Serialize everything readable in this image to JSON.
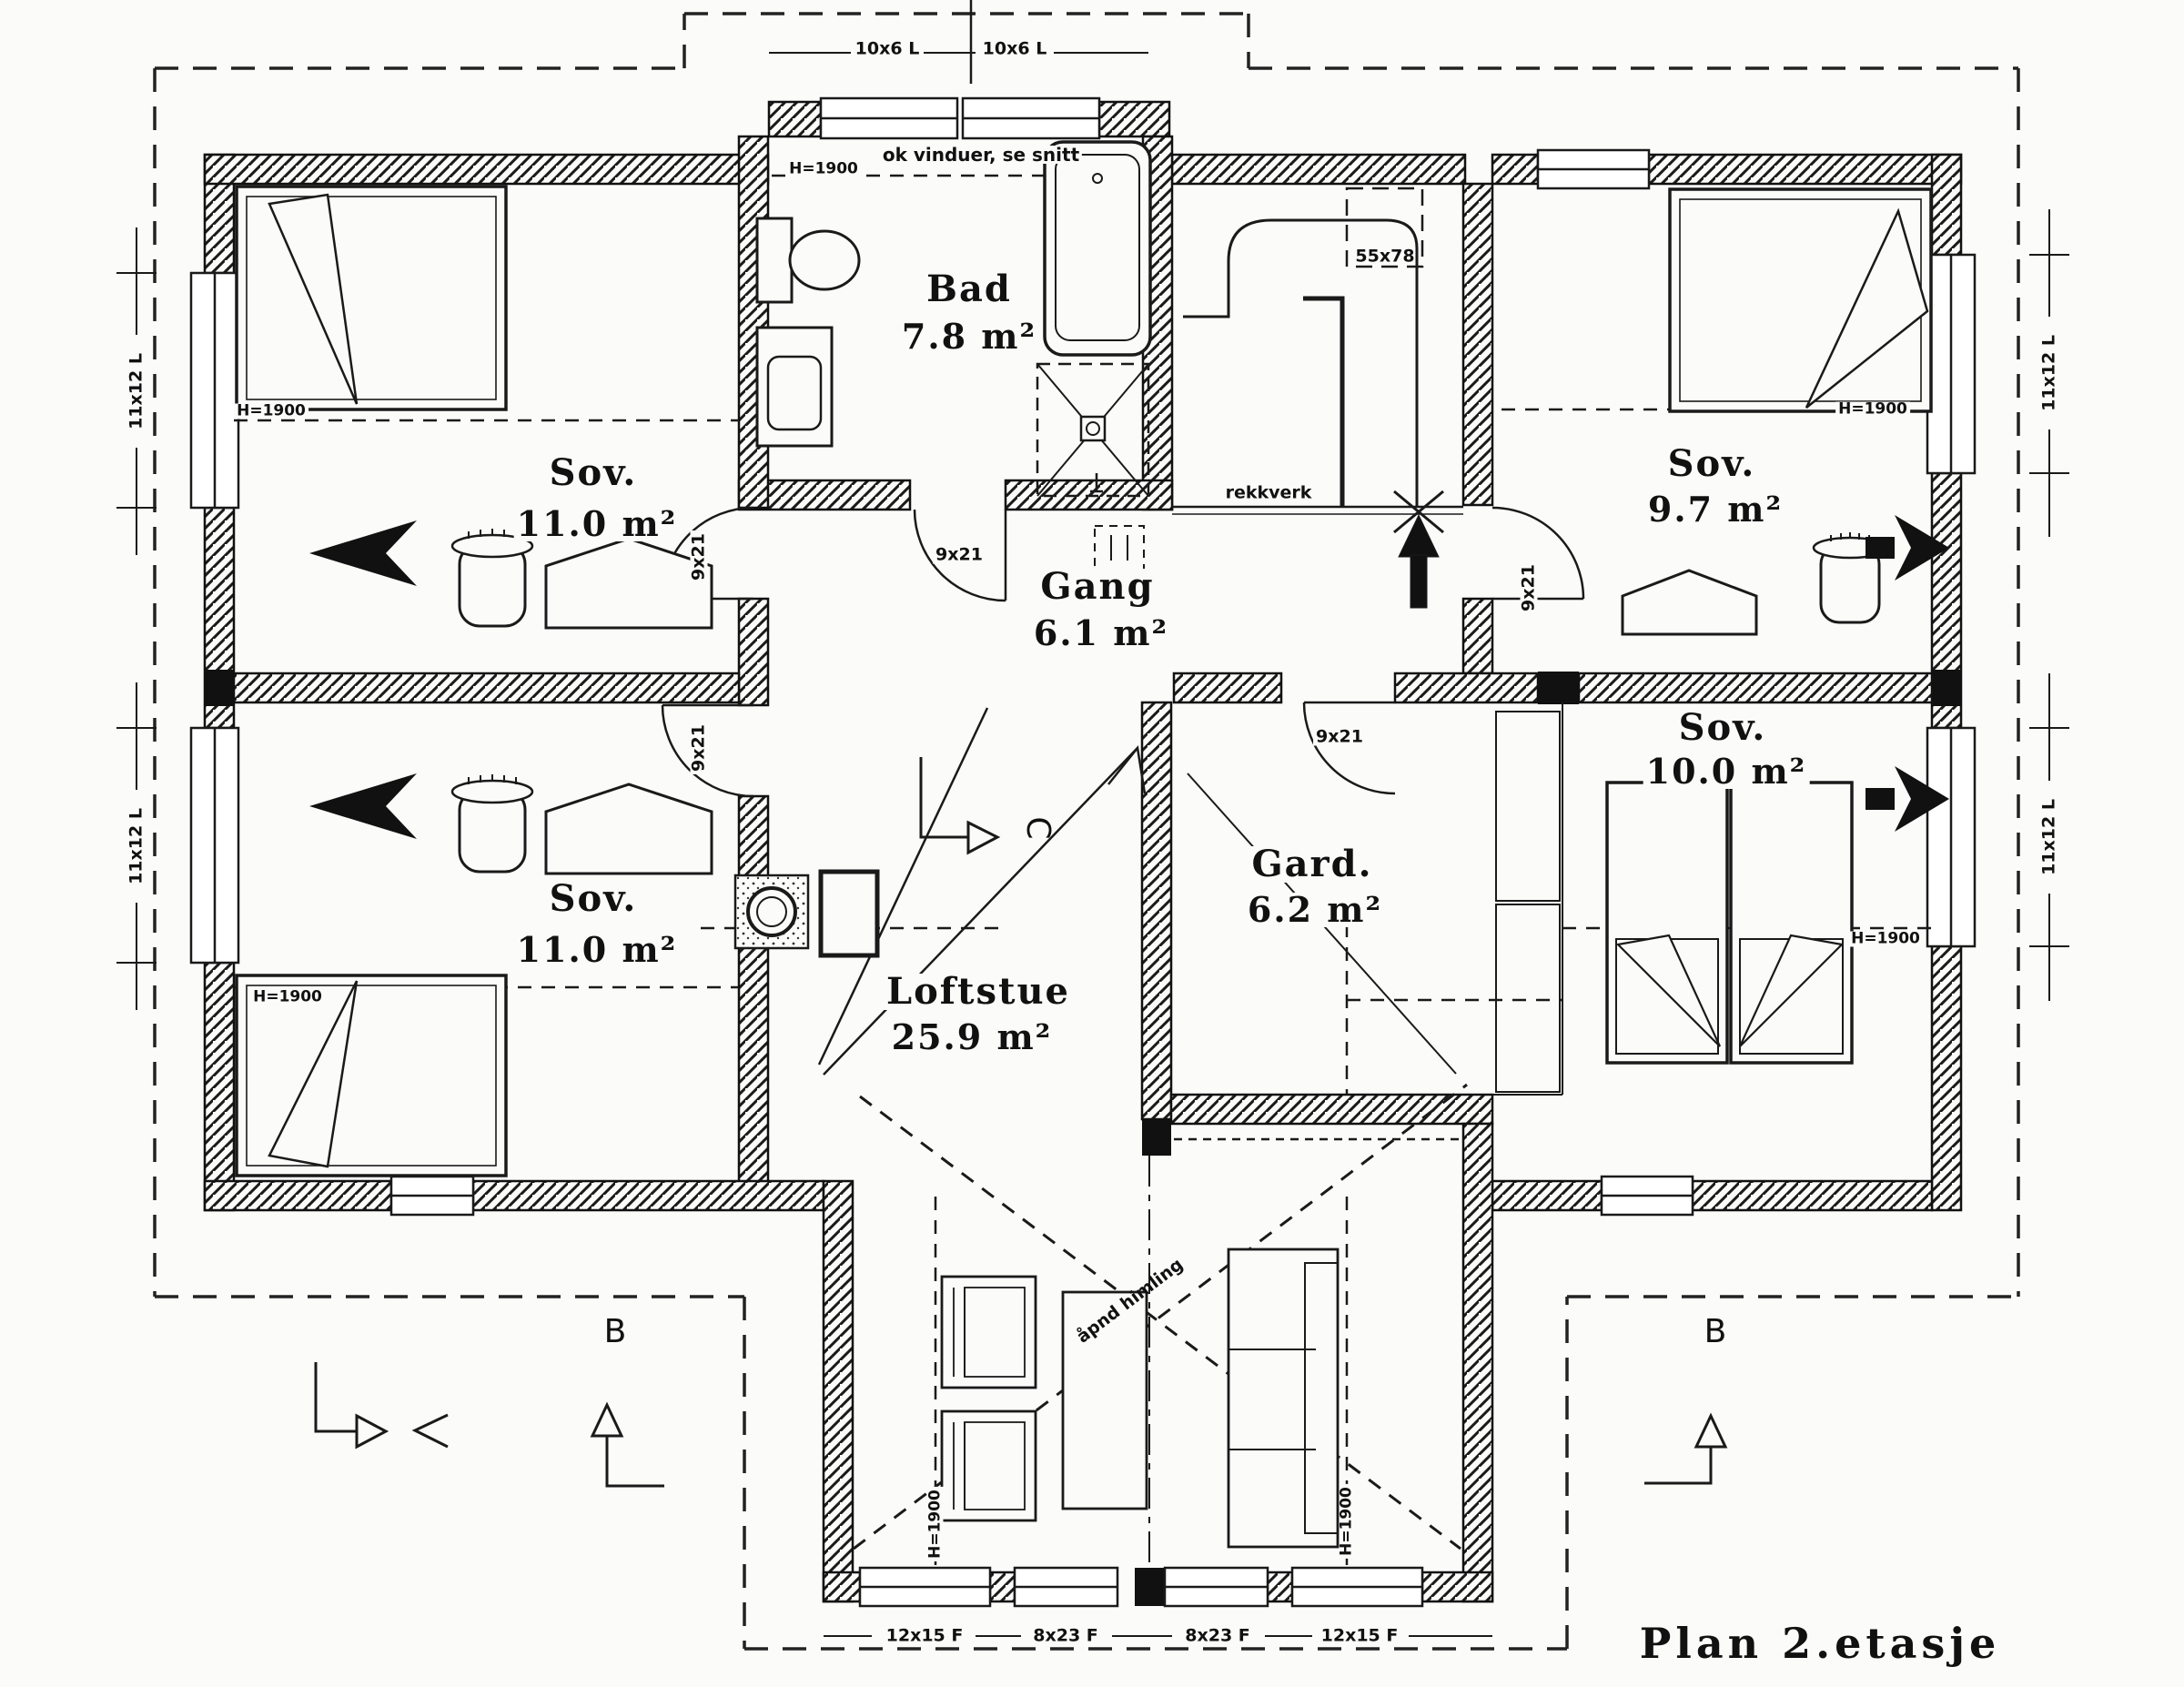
{
  "title": "Plan 2.etasje",
  "rooms": {
    "bad": {
      "name": "Bad",
      "area": "7.8 m²"
    },
    "sov_top_left": {
      "name": "Sov.",
      "area": "11.0 m²"
    },
    "sov_bottom_left": {
      "name": "Sov.",
      "area": "11.0 m²"
    },
    "sov_top_right": {
      "name": "Sov.",
      "area": "9.7 m²"
    },
    "sov_bottom_right": {
      "name": "Sov.",
      "area": "10.0 m²"
    },
    "gang": {
      "name": "Gang",
      "area": "6.1 m²"
    },
    "gard": {
      "name": "Gard.",
      "area": "6.2 m²"
    },
    "loftstue": {
      "name": "Loftstue",
      "area": "25.9 m²"
    }
  },
  "annotations": {
    "windows_note": "ok vinduer, se snitt",
    "railing": "rekkverk",
    "roof_window": "55x78",
    "open_ceiling": "åpnd himling",
    "ceiling_height": "H=1900",
    "door_size": "9x21",
    "dormer_window": "10x6 L",
    "side_window": "11x12 L",
    "bottom_window_large": "12x15 F",
    "bottom_window_small": "8x23 F",
    "section_b": "B",
    "section_c": "C"
  },
  "colors": {
    "ink": "#1a1a1a",
    "paper": "#fbfbfa"
  }
}
